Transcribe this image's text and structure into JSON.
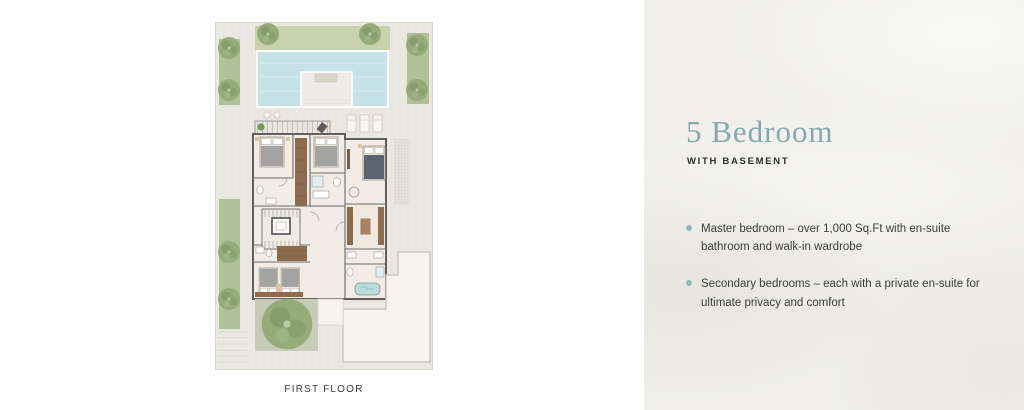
{
  "plan": {
    "caption": "FIRST FLOOR"
  },
  "details": {
    "title": "5 Bedroom",
    "subtitle": "WITH BASEMENT",
    "bullets": [
      "Master bedroom – over 1,000 Sq.Ft with en-suite bathroom and walk-in wardrobe",
      "Secondary bedrooms – each with a private en-suite for ultimate privacy and comfort"
    ]
  },
  "colors": {
    "title_teal": "#86a8ad",
    "bullet_dot": "#8fb6ba",
    "panel_background": "#efeeea",
    "pool_water": "#c5e3e7",
    "lawn_green": "#c8d2ac",
    "tree_green": "#95ab79",
    "wardrobe_brown": "#8d6b4d",
    "wall_gray": "#5f5f5f",
    "plot_background": "#eae8e2"
  }
}
